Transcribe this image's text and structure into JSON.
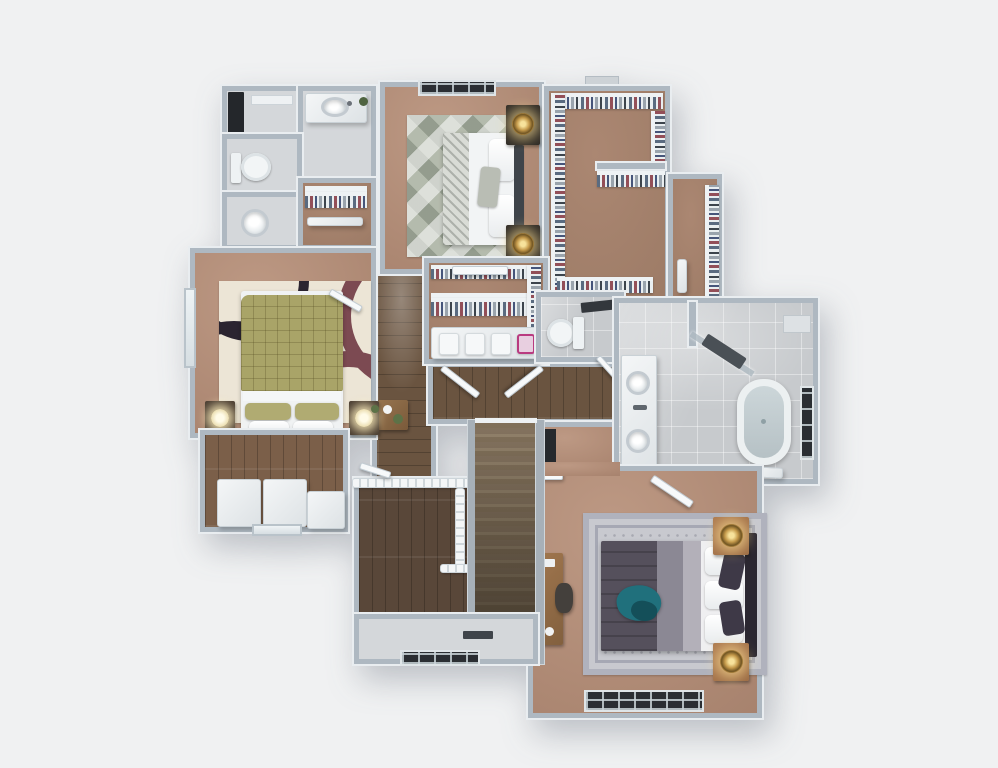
{
  "meta": {
    "title": "3D rendered second-floor plan, top-down view",
    "style": "real-estate dollhouse render"
  },
  "palette": {
    "bg": "#f0f1f2",
    "wall": "#aeb8c1",
    "wallCap": "#e9edf0",
    "carpet": "#ad8873",
    "carpetDark": "#9f7d68",
    "wood": "#6a5440",
    "woodDark": "#594739",
    "woodLight": "#7b5f49",
    "tile": "#c7cacd",
    "tileLight": "#d4d7da",
    "white": "#f4f6f7",
    "olive": "#a9a468",
    "cream": "#ece5d6",
    "duvet": "#55505c",
    "runner": "#8b8894",
    "teal": "#20707c",
    "gold": "#c59a4b",
    "copper": "#9a6a44",
    "frameDark": "#2a2e33",
    "maroon": "#7c4a52",
    "ink": "#3a3f45"
  },
  "rooms": [
    {
      "name": "Linen Room",
      "floor": "tile"
    },
    {
      "name": "Hall Bath Vanity",
      "floor": "tile"
    },
    {
      "name": "Hall Water Closet",
      "floor": "tile"
    },
    {
      "name": "Powder Room",
      "floor": "tile"
    },
    {
      "name": "Hall Closet",
      "floor": "carpet"
    },
    {
      "name": "Bedroom 2",
      "floor": "carpet"
    },
    {
      "name": "Walk-in Closet",
      "floor": "carpet"
    },
    {
      "name": "Walk-in Closet Wing",
      "floor": "carpet"
    },
    {
      "name": "Bedroom 3",
      "floor": "carpet"
    },
    {
      "name": "Window Nook",
      "floor": "wood"
    },
    {
      "name": "Upper Hall",
      "floor": "wood"
    },
    {
      "name": "Gallery Hall",
      "floor": "wood"
    },
    {
      "name": "Laundry Closet",
      "floor": "carpet"
    },
    {
      "name": "Master Water Closet",
      "floor": "tile"
    },
    {
      "name": "Master Bathroom",
      "floor": "tile"
    },
    {
      "name": "Master Bedroom",
      "floor": "carpet"
    },
    {
      "name": "Master Entry",
      "floor": "carpet"
    },
    {
      "name": "Loft Overlook",
      "floor": "wood"
    },
    {
      "name": "Staircase",
      "floor": "wood"
    },
    {
      "name": "Stair Landing",
      "floor": "tile"
    }
  ],
  "furniture": {
    "bed2": "Queen bed with white duvet and patterned shams",
    "bed3": "Queen bed with olive quilted comforter",
    "bedMaster": "King bed with plum duvet and teal throw",
    "rug2": "Geometric gray-green rug",
    "rug3": "Bold cream / black / mauve rug",
    "rugMaster": "Ornate silver-gray rug",
    "tub": "Freestanding soaking tub",
    "shower": "Corner glass shower",
    "vanityDouble": "Double vanity with round sinks",
    "toilet": "Toilet",
    "pedestalSink": "Pedestal sink",
    "sinkVanity": "Vanity sink",
    "stairs": "Staircase down",
    "railing": "Loft stair railing",
    "desk": "Writing desk with chair",
    "console": "Hall console with plant",
    "benches": "White storage benches",
    "laundryCounter": "Folding counter with baskets",
    "rack": "Clothes rack with hanging clothes",
    "nightstand": "Nightstand",
    "lamp": "Table lamp",
    "window": "Window",
    "door": "Door leaf",
    "chimney": "Chimney chase"
  }
}
